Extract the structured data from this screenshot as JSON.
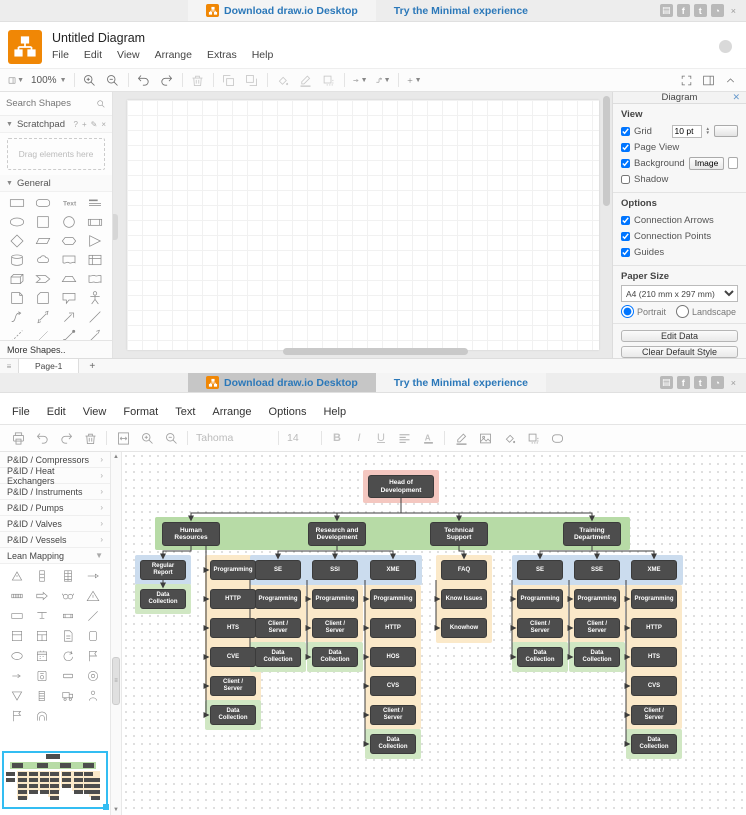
{
  "banner": {
    "download": "Download draw.io Desktop",
    "minimal": "Try the Minimal experience",
    "link_color": "#2b78b9",
    "social_icons": [
      "blog-icon",
      "facebook-icon",
      "twitter-icon",
      "github-icon"
    ],
    "close": "×"
  },
  "app1": {
    "title": "Untitled Diagram",
    "menus": [
      "File",
      "Edit",
      "View",
      "Arrange",
      "Extras",
      "Help"
    ],
    "toolbar": {
      "zoom": "100%"
    },
    "sidebar": {
      "search_placeholder": "Search Shapes",
      "scratchpad_title": "Scratchpad",
      "scratchpad_hint": "Drag elements here",
      "general_title": "General",
      "more_shapes": "More Shapes..",
      "shapes": [
        "rectangle",
        "rounded-rectangle",
        "text",
        "heading",
        "ellipse",
        "square",
        "circle",
        "process",
        "diamond",
        "parallelogram",
        "hexagon",
        "triangle",
        "cylinder",
        "cloud",
        "document",
        "internal-storage",
        "cube",
        "step",
        "trapezoid",
        "tape",
        "note",
        "card",
        "callout",
        "actor",
        "curve",
        "bidirectional-arrow",
        "arrow",
        "line",
        "dashed-line",
        "thin-line",
        "dotted-line",
        "directional-line"
      ]
    },
    "page_tab": "Page-1",
    "panel": {
      "tab": "Diagram",
      "view_title": "View",
      "grid_label": "Grid",
      "grid_size": "10 pt",
      "page_view_label": "Page View",
      "background_label": "Background",
      "image_button": "Image",
      "shadow_label": "Shadow",
      "options_title": "Options",
      "options": [
        "Connection Arrows",
        "Connection Points",
        "Guides"
      ],
      "options_checked": [
        true,
        true,
        true
      ],
      "paper_title": "Paper Size",
      "paper_value": "A4 (210 mm x 297 mm)",
      "portrait": "Portrait",
      "landscape": "Landscape",
      "edit_data": "Edit Data",
      "clear_default": "Clear Default Style"
    },
    "checks": {
      "grid": true,
      "page_view": true,
      "background": true,
      "shadow": false,
      "portrait": true,
      "landscape": false
    }
  },
  "app2": {
    "menus": [
      "File",
      "Edit",
      "View",
      "Format",
      "Text",
      "Arrange",
      "Options",
      "Help"
    ],
    "toolbar": {
      "font": "Tahoma",
      "size": "14"
    },
    "sidebar_sections": [
      "P&ID / Compressors",
      "P&ID / Heat Exchangers",
      "P&ID / Instruments",
      "P&ID / Pumps",
      "P&ID / Valves",
      "P&ID / Vessels",
      "Lean Mapping"
    ],
    "lean_shapes": [
      "burst-triangle",
      "stacked-box",
      "grid-box",
      "push-line",
      "stripes",
      "arrow-right",
      "glasses",
      "warning-triangle",
      "box-label",
      "tee",
      "data-box",
      "line",
      "window",
      "window-grid",
      "document-card",
      "cylinder-drum",
      "ellipse-open",
      "calendar",
      "circular-arrow",
      "flag-note",
      "small-arrow",
      "circle-box",
      "plate",
      "target",
      "inverted-triangle",
      "list-lines",
      "truck",
      "operator",
      "flag",
      "arch"
    ]
  },
  "chart_data": {
    "type": "org-chart",
    "title": "Head of Development organization chart",
    "colors": {
      "node": "#4d4d4d",
      "pink": "#f4c7c0",
      "band": "#b7dba6",
      "blue": "#cbdcee",
      "orange": "#fbe9c9",
      "green": "#d0e7c3"
    },
    "row_base": 108,
    "row_pitch": 29,
    "item_size": {
      "w": 46,
      "h": 20
    },
    "panels": [
      {
        "x": 241,
        "y": 18,
        "w": 76,
        "h": 33,
        "color": "pink"
      },
      {
        "x": 33,
        "y": 65,
        "w": 475,
        "h": 33,
        "color": "band"
      },
      {
        "x": 13,
        "y": 103,
        "w": 56,
        "h": 30,
        "color": "blue"
      },
      {
        "x": 13,
        "y": 132,
        "w": 56,
        "h": 30,
        "color": "green"
      },
      {
        "x": 83,
        "y": 103,
        "w": 56,
        "h": 146,
        "color": "orange"
      },
      {
        "x": 83,
        "y": 248,
        "w": 56,
        "h": 30,
        "color": "green"
      },
      {
        "x": 128,
        "y": 103,
        "w": 172,
        "h": 30,
        "color": "blue"
      },
      {
        "x": 128,
        "y": 133,
        "w": 56,
        "h": 57,
        "color": "orange"
      },
      {
        "x": 128,
        "y": 190,
        "w": 56,
        "h": 30,
        "color": "green"
      },
      {
        "x": 185,
        "y": 133,
        "w": 56,
        "h": 57,
        "color": "orange"
      },
      {
        "x": 185,
        "y": 190,
        "w": 56,
        "h": 30,
        "color": "green"
      },
      {
        "x": 243,
        "y": 133,
        "w": 56,
        "h": 144,
        "color": "orange"
      },
      {
        "x": 243,
        "y": 277,
        "w": 56,
        "h": 30,
        "color": "green"
      },
      {
        "x": 314,
        "y": 103,
        "w": 56,
        "h": 88,
        "color": "orange"
      },
      {
        "x": 390,
        "y": 103,
        "w": 171,
        "h": 30,
        "color": "blue"
      },
      {
        "x": 390,
        "y": 133,
        "w": 56,
        "h": 57,
        "color": "orange"
      },
      {
        "x": 390,
        "y": 190,
        "w": 56,
        "h": 30,
        "color": "green"
      },
      {
        "x": 447,
        "y": 133,
        "w": 56,
        "h": 57,
        "color": "orange"
      },
      {
        "x": 447,
        "y": 190,
        "w": 56,
        "h": 30,
        "color": "green"
      },
      {
        "x": 504,
        "y": 133,
        "w": 56,
        "h": 144,
        "color": "orange"
      },
      {
        "x": 504,
        "y": 277,
        "w": 56,
        "h": 30,
        "color": "green"
      }
    ],
    "nodes": [
      {
        "id": "head",
        "label": "Head of Development",
        "x": 246,
        "y": 23,
        "w": 66,
        "h": 23,
        "big": true
      },
      {
        "id": "hr",
        "label": "Human Resources",
        "x": 40,
        "y": 70,
        "w": 58,
        "h": 24,
        "big": true
      },
      {
        "id": "rnd",
        "label": "Research and Development",
        "x": 186,
        "y": 70,
        "w": 58,
        "h": 24,
        "big": true
      },
      {
        "id": "ts",
        "label": "Technical Support",
        "x": 308,
        "y": 70,
        "w": 58,
        "h": 24,
        "big": true
      },
      {
        "id": "td",
        "label": "Training Department",
        "x": 441,
        "y": 70,
        "w": 58,
        "h": 24,
        "big": true
      },
      {
        "id": "rr",
        "label": "Regular Report",
        "x": 18,
        "r": 0
      },
      {
        "id": "dcrr",
        "label": "Data Collection",
        "x": 18,
        "r": 1
      },
      {
        "id": "p1",
        "label": "Programming",
        "x": 88,
        "r": 0
      },
      {
        "id": "h1",
        "label": "HTTP",
        "x": 88,
        "r": 1
      },
      {
        "id": "t1",
        "label": "HTS",
        "x": 88,
        "r": 2
      },
      {
        "id": "c1",
        "label": "CVE",
        "x": 88,
        "r": 3
      },
      {
        "id": "cs1",
        "label": "Client / Server",
        "x": 88,
        "r": 4
      },
      {
        "id": "dc1",
        "label": "Data Collection",
        "x": 88,
        "r": 5
      },
      {
        "id": "se1",
        "label": "SE",
        "x": 133,
        "r": 0
      },
      {
        "id": "p2",
        "label": "Programming",
        "x": 133,
        "r": 1
      },
      {
        "id": "cs2",
        "label": "Client / Server",
        "x": 133,
        "r": 2
      },
      {
        "id": "dc2",
        "label": "Data Collection",
        "x": 133,
        "r": 3
      },
      {
        "id": "ssi",
        "label": "SSI",
        "x": 190,
        "r": 0
      },
      {
        "id": "p3",
        "label": "Programming",
        "x": 190,
        "r": 1
      },
      {
        "id": "cs3",
        "label": "Client / Server",
        "x": 190,
        "r": 2
      },
      {
        "id": "dc3",
        "label": "Data Collection",
        "x": 190,
        "r": 3
      },
      {
        "id": "xme1",
        "label": "XME",
        "x": 248,
        "r": 0
      },
      {
        "id": "p4",
        "label": "Programming",
        "x": 248,
        "r": 1
      },
      {
        "id": "h2",
        "label": "HTTP",
        "x": 248,
        "r": 2
      },
      {
        "id": "hos",
        "label": "HOS",
        "x": 248,
        "r": 3
      },
      {
        "id": "cvs1",
        "label": "CVS",
        "x": 248,
        "r": 4
      },
      {
        "id": "cs4",
        "label": "Client / Server",
        "x": 248,
        "r": 5
      },
      {
        "id": "dc4",
        "label": "Data Collection",
        "x": 248,
        "r": 6
      },
      {
        "id": "faq",
        "label": "FAQ",
        "x": 319,
        "r": 0
      },
      {
        "id": "ki",
        "label": "Know Issues",
        "x": 319,
        "r": 1
      },
      {
        "id": "kh",
        "label": "Knowhow",
        "x": 319,
        "r": 2
      },
      {
        "id": "se2",
        "label": "SE",
        "x": 395,
        "r": 0
      },
      {
        "id": "p5",
        "label": "Programming",
        "x": 395,
        "r": 1
      },
      {
        "id": "cs5",
        "label": "Client / Server",
        "x": 395,
        "r": 2
      },
      {
        "id": "dc5",
        "label": "Data Collection",
        "x": 395,
        "r": 3
      },
      {
        "id": "sse",
        "label": "SSE",
        "x": 452,
        "r": 0
      },
      {
        "id": "p6",
        "label": "Programming",
        "x": 452,
        "r": 1
      },
      {
        "id": "cs6",
        "label": "Client / Server",
        "x": 452,
        "r": 2
      },
      {
        "id": "dc6",
        "label": "Data Collection",
        "x": 452,
        "r": 3
      },
      {
        "id": "xme2",
        "label": "XME",
        "x": 509,
        "r": 0
      },
      {
        "id": "p7",
        "label": "Programming",
        "x": 509,
        "r": 1
      },
      {
        "id": "h3",
        "label": "HTTP",
        "x": 509,
        "r": 2
      },
      {
        "id": "t2",
        "label": "HTS",
        "x": 509,
        "r": 3
      },
      {
        "id": "cvs2",
        "label": "CVS",
        "x": 509,
        "r": 4
      },
      {
        "id": "cs7",
        "label": "Client / Server",
        "x": 509,
        "r": 5
      },
      {
        "id": "dc7",
        "label": "Data Collection",
        "x": 509,
        "r": 6
      }
    ],
    "edges": [
      {
        "type": "fan",
        "from": "head",
        "to": [
          "hr",
          "rnd",
          "ts",
          "td"
        ]
      },
      {
        "type": "fan",
        "from": "hr",
        "to": [
          "rr"
        ]
      },
      {
        "type": "arrow",
        "from": "rr",
        "to": "dcrr"
      },
      {
        "type": "spine",
        "x": 84,
        "from": "hr",
        "to": [
          "p1",
          "h1",
          "t1",
          "c1",
          "cs1",
          "dc1"
        ]
      },
      {
        "type": "fan",
        "from": "rnd",
        "to": [
          "se1",
          "ssi",
          "xme1"
        ]
      },
      {
        "type": "spine",
        "from": "se1",
        "to": [
          "p2",
          "cs2",
          "dc2"
        ]
      },
      {
        "type": "spine",
        "from": "ssi",
        "to": [
          "p3",
          "cs3",
          "dc3"
        ]
      },
      {
        "type": "spine",
        "from": "xme1",
        "to": [
          "p4",
          "h2",
          "hos",
          "cvs1",
          "cs4",
          "dc4"
        ]
      },
      {
        "type": "fan",
        "from": "ts",
        "to": [
          "faq"
        ]
      },
      {
        "type": "spine",
        "from": "faq",
        "to": [
          "ki",
          "kh"
        ]
      },
      {
        "type": "fan",
        "from": "td",
        "to": [
          "se2",
          "sse",
          "xme2"
        ]
      },
      {
        "type": "spine",
        "from": "se2",
        "to": [
          "p5",
          "cs5",
          "dc5"
        ]
      },
      {
        "type": "spine",
        "from": "sse",
        "to": [
          "p6",
          "cs6",
          "dc6"
        ]
      },
      {
        "type": "spine",
        "from": "xme2",
        "to": [
          "p7",
          "h3",
          "t2",
          "cvs2",
          "cs7",
          "dc7"
        ]
      }
    ]
  }
}
